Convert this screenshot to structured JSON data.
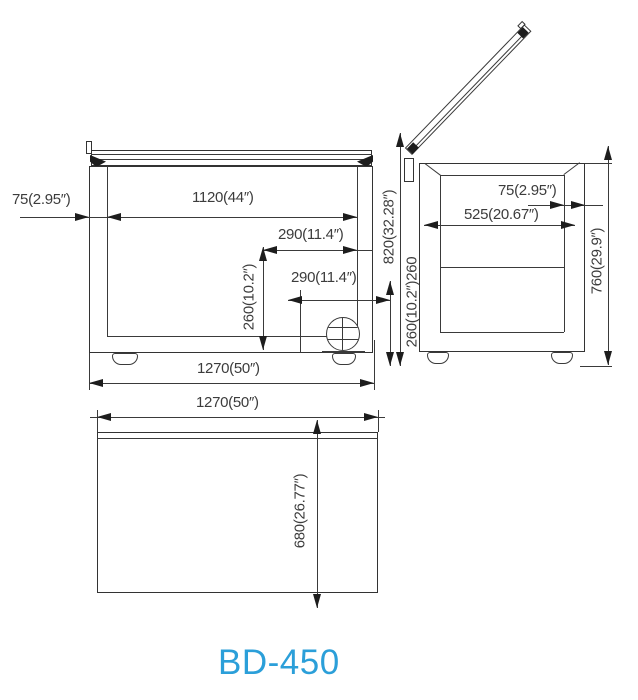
{
  "title": "BD-450",
  "accent_color": "#2b9fd9",
  "line_color": "#3a3a3a",
  "views": {
    "front": {
      "name": "front elevation",
      "dims": {
        "wall_thickness": "75(2.95″)",
        "inner_width": "1120(44″)",
        "offset_upper": "290(11.4″)",
        "offset_lower": "290(11.4″)",
        "inner_height": "260(10.2″)",
        "total_height": "820(32.28″)",
        "mid_height": "260(10.2″)260",
        "total_width": "1270(50″)"
      }
    },
    "side": {
      "name": "side elevation with open lid",
      "dims": {
        "wall_thickness": "75(2.95″)",
        "inner_depth": "525(20.67″)",
        "total_height": "760(29.9″)"
      }
    },
    "plan": {
      "name": "plan (footprint)",
      "dims": {
        "total_width": "1270(50″)",
        "total_depth": "680(26.77″)"
      }
    }
  }
}
